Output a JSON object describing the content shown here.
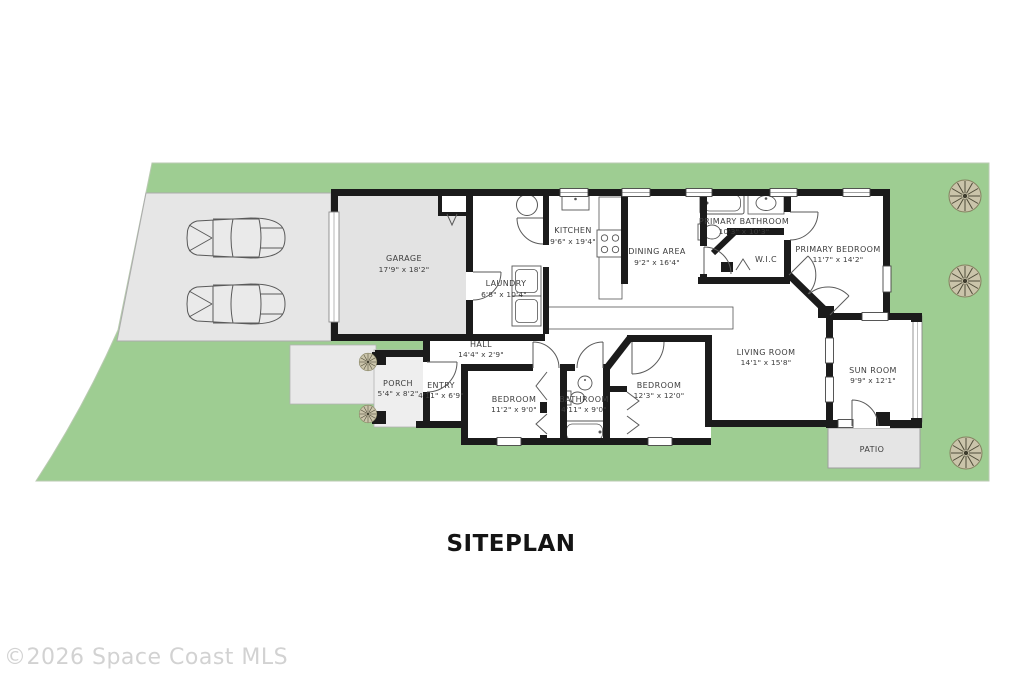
{
  "title": "SITEPLAN",
  "watermark": "©2026 Space Coast MLS",
  "colors": {
    "lawn": "#9ecd92",
    "driveway": "#e6e6e6",
    "hardscape": "#ececec",
    "garage_floor": "#e3e3e3",
    "wall": "#1b1b1b",
    "tree_canopy": "#cac4aa",
    "label_text": "#3d3d3d",
    "title_text": "#141414",
    "watermark_text": "#d2d2d2"
  },
  "icons": {
    "car": "top-view-car",
    "tree": "top-view-tree",
    "bush": "top-view-bush"
  },
  "rooms": [
    {
      "name": "GARAGE",
      "dims": "17'9\" x 18'2\""
    },
    {
      "name": "LAUNDRY",
      "dims": "6'8\" x 10'4\""
    },
    {
      "name": "KITCHEN",
      "dims": "9'6\" x 19'4\""
    },
    {
      "name": "DINING AREA",
      "dims": "9'2\" x 16'4\""
    },
    {
      "name": "PRIMARY BATHROOM",
      "dims": "10'3\" x 10'3\""
    },
    {
      "name": "W.I.C",
      "dims": ""
    },
    {
      "name": "PRIMARY BEDROOM",
      "dims": "11'7\" x 14'2\""
    },
    {
      "name": "LIVING ROOM",
      "dims": "14'1\" x 15'8\""
    },
    {
      "name": "SUN ROOM",
      "dims": "9'9\" x 12'1\""
    },
    {
      "name": "PATIO",
      "dims": ""
    },
    {
      "name": "HALL",
      "dims": "14'4\" x 2'9\""
    },
    {
      "name": "PORCH",
      "dims": "5'4\" x 8'2\""
    },
    {
      "name": "ENTRY",
      "dims": "4'11\" x 6'9\""
    },
    {
      "name": "BEDROOM",
      "dims": "11'2\" x 9'0\""
    },
    {
      "name": "BATHROOM",
      "dims": "4'11\" x 9'0\""
    },
    {
      "name": "BEDROOM",
      "dims": "12'3\" x 12'0\""
    }
  ]
}
